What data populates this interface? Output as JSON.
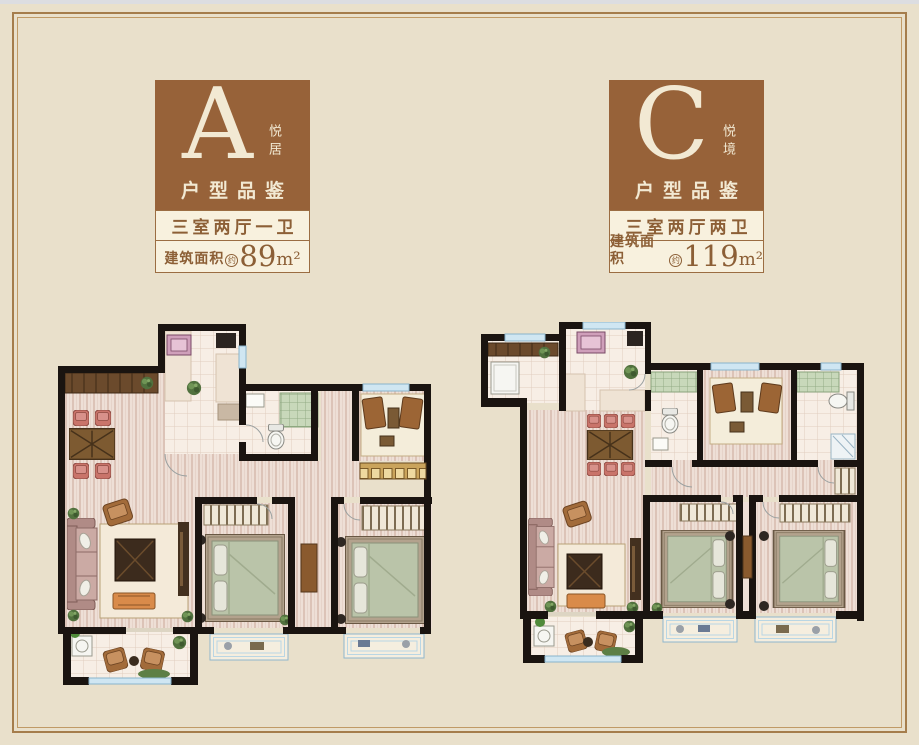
{
  "page": {
    "background": "#e9e0cb",
    "top_strip_color": "#dcdde1",
    "frame_color": "#a57d4c",
    "accent_brown": "#976239",
    "text_brown": "#8c5f36"
  },
  "cards": [
    {
      "letter": "A",
      "tag": "悦居",
      "series": "户型品鉴",
      "layout": "三室两厅一卫",
      "area_label": "建筑面积",
      "area_approx": "约",
      "area_value": "89",
      "area_unit": "m²"
    },
    {
      "letter": "C",
      "tag": "悦境",
      "series": "户型品鉴",
      "layout": "三室两厅两卫",
      "area_label": "建筑面积",
      "area_approx": "约",
      "area_value": "119",
      "area_unit": "m²"
    }
  ],
  "floorplans": [
    {
      "id": "A",
      "rooms": [
        "厨房",
        "餐厅",
        "卫生间",
        "书房",
        "客厅",
        "卧室",
        "卧室",
        "阳台"
      ]
    },
    {
      "id": "C",
      "rooms": [
        "生活阳台",
        "厨房",
        "卫生间",
        "书房",
        "卫生间",
        "餐厅",
        "客厅",
        "卧室",
        "主卧",
        "阳台"
      ]
    }
  ]
}
